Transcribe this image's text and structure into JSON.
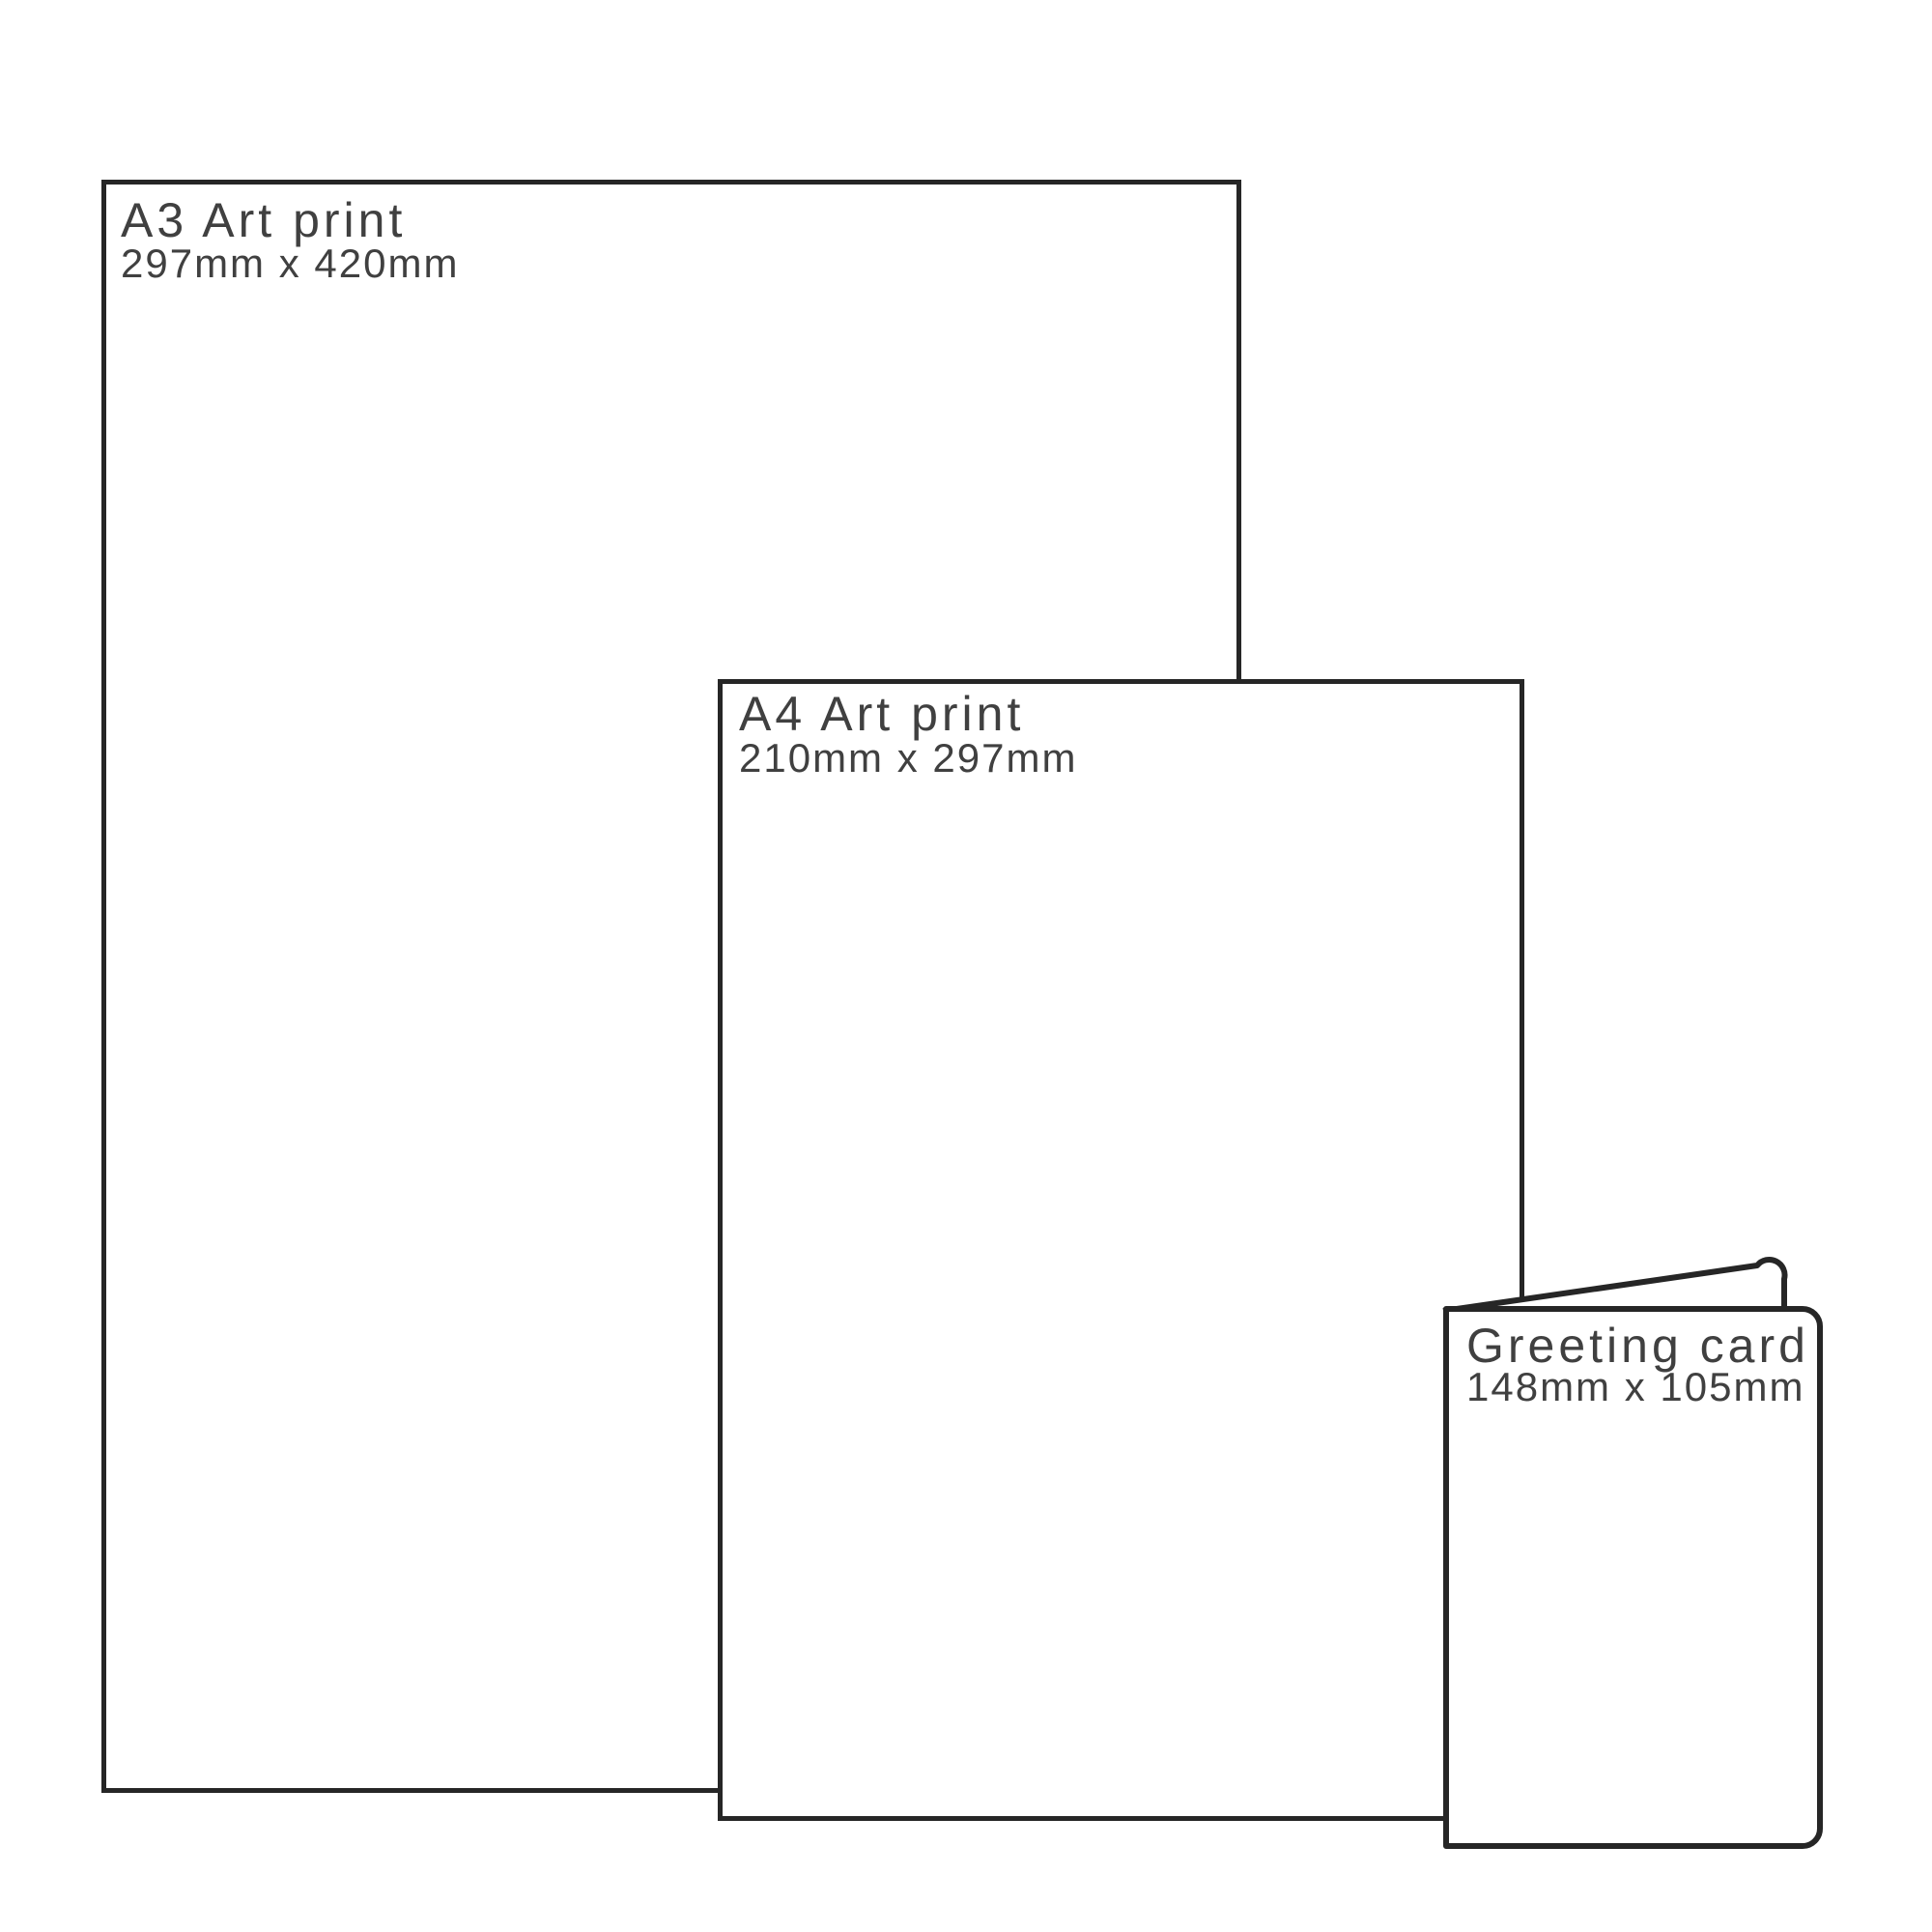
{
  "page": {
    "background_color": "#ffffff",
    "outline_color": "#262626",
    "label_color": "#404040"
  },
  "sizes": {
    "a3": {
      "title": "A3 Art print",
      "dimensions": "297mm x 420mm"
    },
    "a4": {
      "title": "A4 Art print",
      "dimensions": "210mm x 297mm"
    },
    "greeting_card": {
      "title": "Greeting card",
      "dimensions": "148mm x 105mm"
    }
  }
}
